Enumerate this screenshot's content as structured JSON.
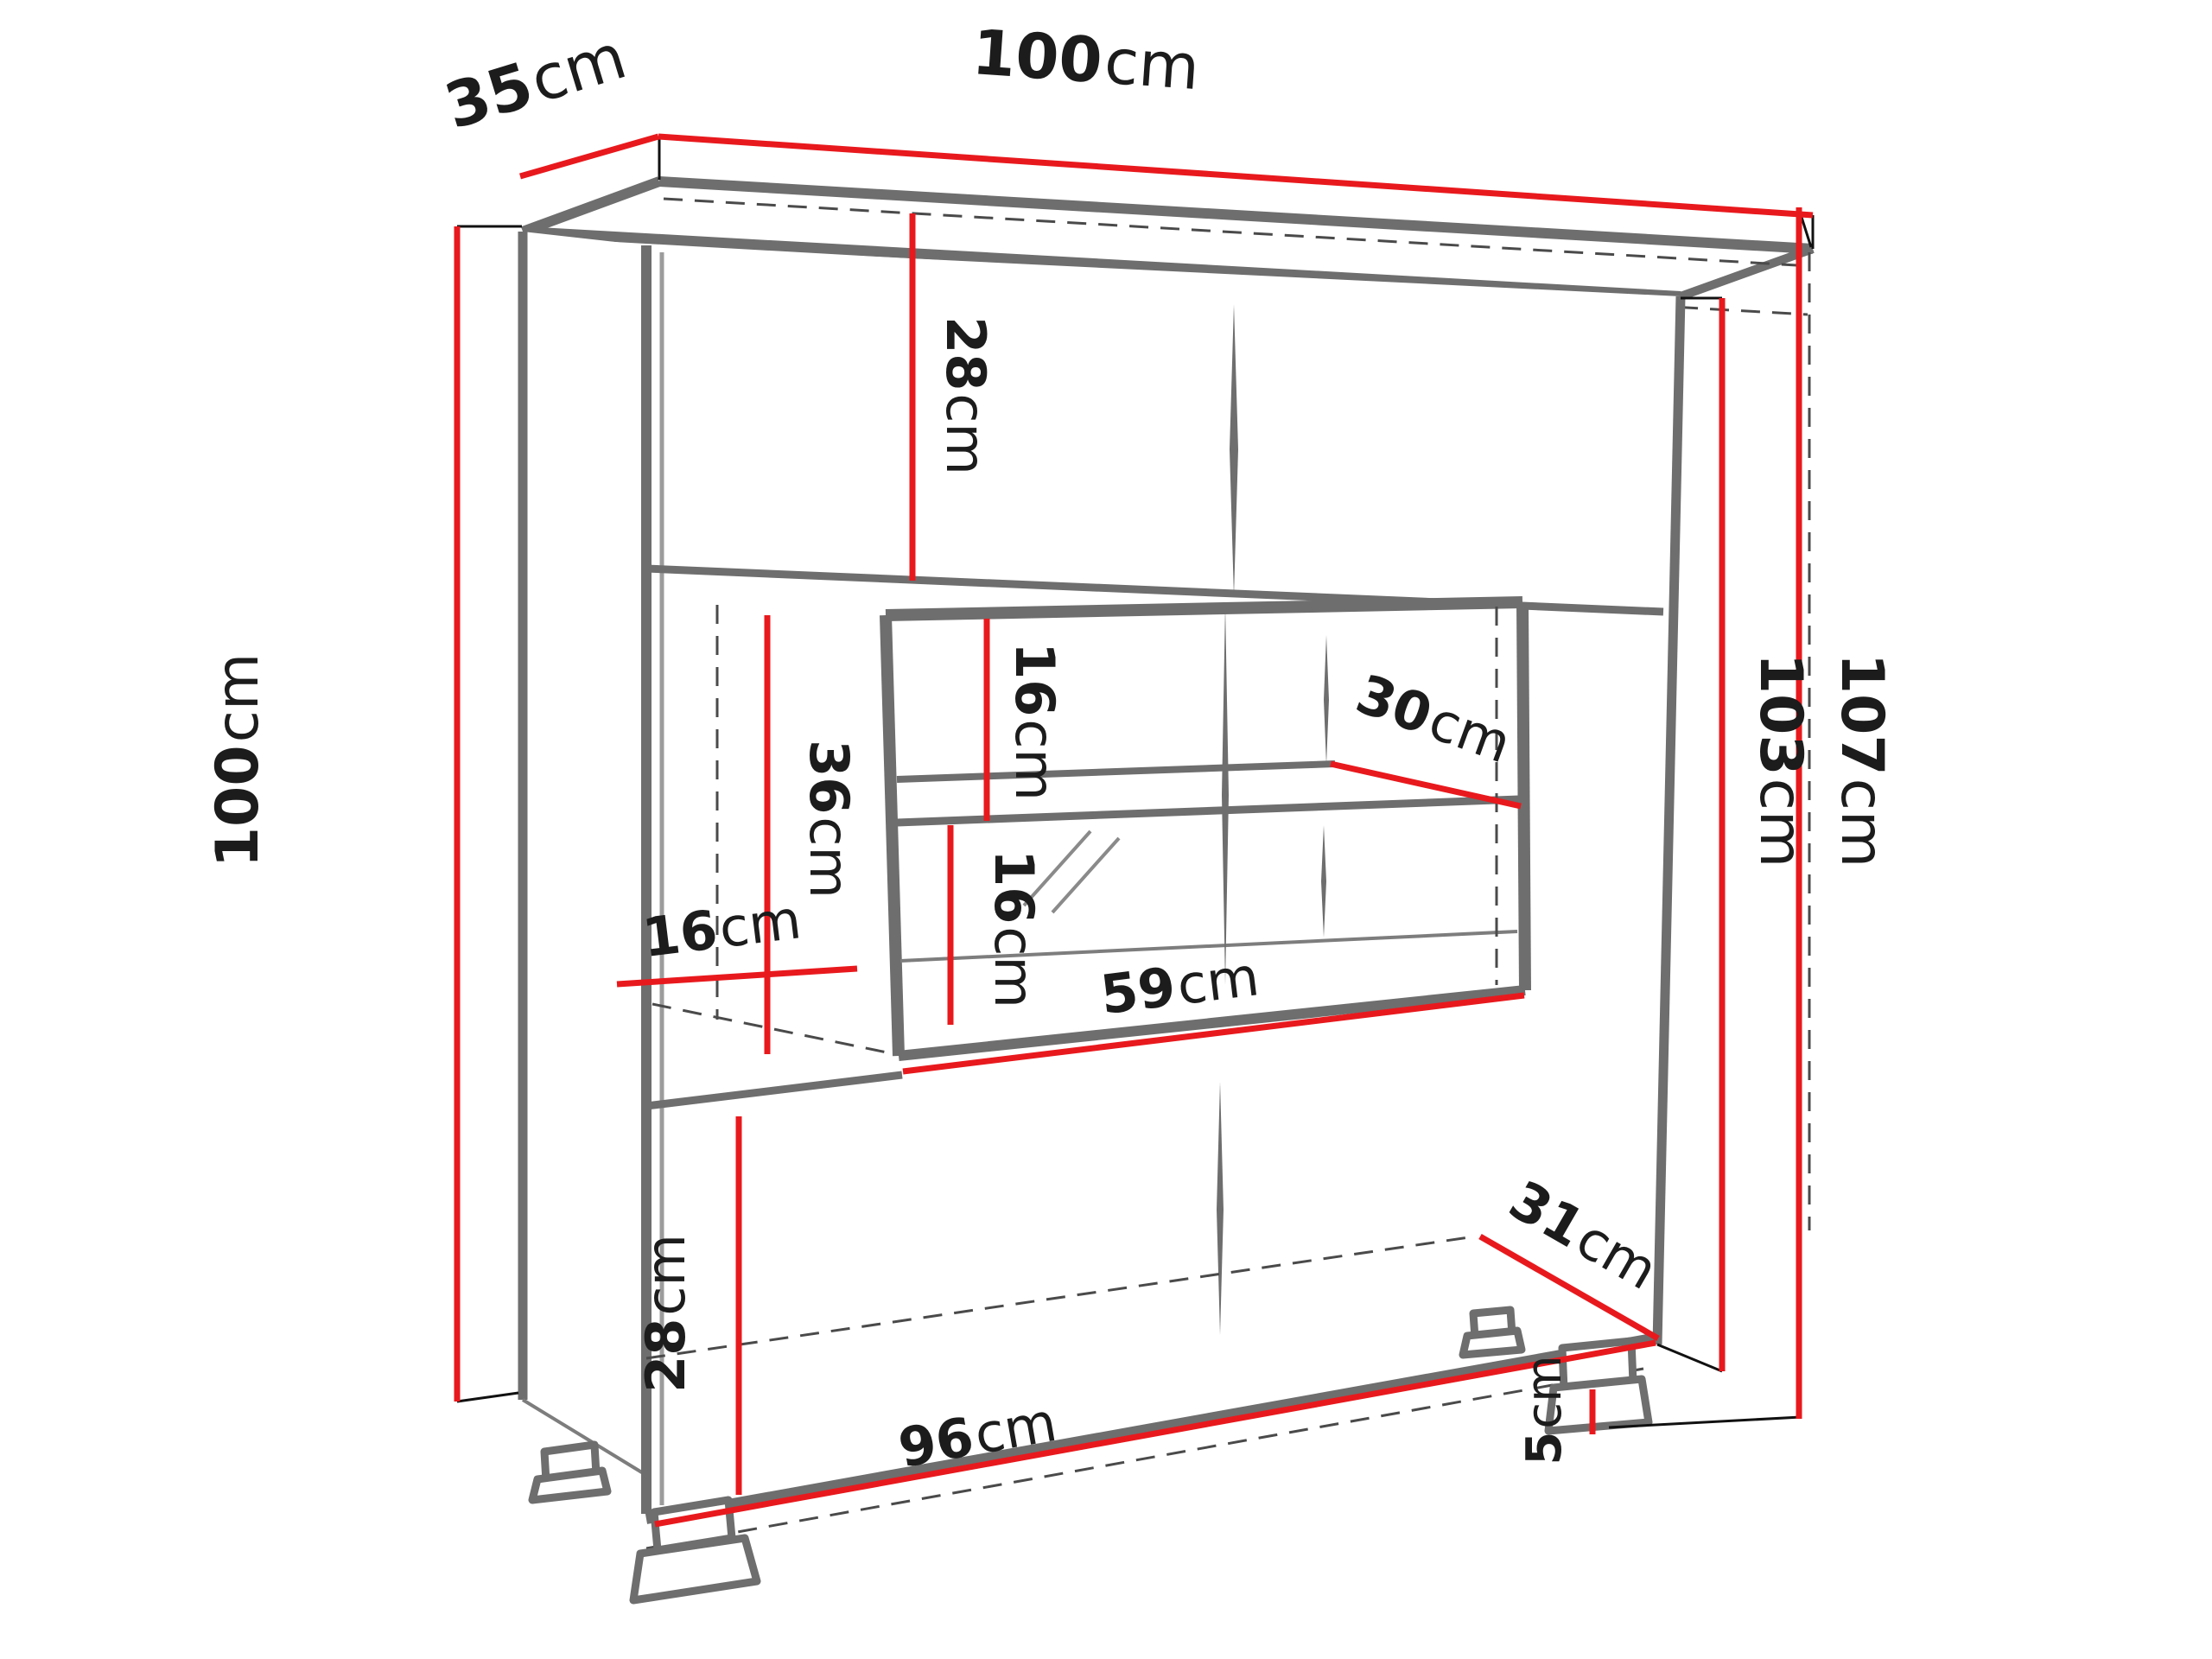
{
  "figure": {
    "type": "furniture-dimension-diagram",
    "subject": "display cabinet with glass vitrine, shelves and feet",
    "background": "#ffffff"
  },
  "colors": {
    "dimension_line": "#e8191d",
    "edge_dark": "#6e6e6e",
    "edge_light": "#9c9c9c",
    "hidden_line": "#4a4a4a",
    "label_text": "#1c1c1c"
  },
  "dimensions": {
    "depth_top": {
      "value": "35",
      "unit": "cm"
    },
    "width_top": {
      "value": "100",
      "unit": "cm"
    },
    "height_left": {
      "value": "100",
      "unit": "cm"
    },
    "height_carcass_right": {
      "value": "103",
      "unit": "cm"
    },
    "height_total_right": {
      "value": "107",
      "unit": "cm"
    },
    "top_section_height": {
      "value": "28",
      "unit": "cm"
    },
    "vitrine_upper_gap": {
      "value": "16",
      "unit": "cm"
    },
    "glass_shelf_depth": {
      "value": "30",
      "unit": "cm"
    },
    "middle_section_height": {
      "value": "36",
      "unit": "cm"
    },
    "vitrine_lower_gap": {
      "value": "16",
      "unit": "cm"
    },
    "left_compartment_width": {
      "value": "16",
      "unit": "cm"
    },
    "vitrine_width": {
      "value": "59",
      "unit": "cm"
    },
    "bottom_section_height": {
      "value": "28",
      "unit": "cm"
    },
    "bottom_width": {
      "value": "96",
      "unit": "cm"
    },
    "bottom_depth": {
      "value": "31",
      "unit": "cm"
    },
    "feet_height": {
      "value": "5",
      "unit": "cm"
    }
  }
}
